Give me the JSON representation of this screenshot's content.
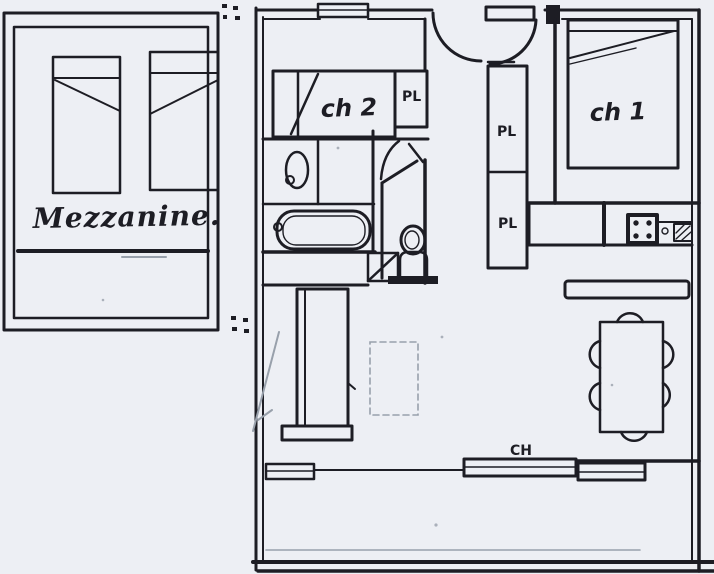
{
  "plan": {
    "kind": "hand-drawn apartment floor plan (scan)",
    "colors": {
      "paper": "#edeff4",
      "ink": "#1d1d24",
      "faint_ink": "#98a0ab"
    },
    "labels": {
      "mezzanine": "Mezzanine.",
      "bedroom2": "ch 2",
      "bedroom1": "ch 1",
      "closet_bedroom2": "PL",
      "closet_hall_upper": "PL",
      "closet_hall_lower": "PL",
      "heating": "CH"
    }
  }
}
